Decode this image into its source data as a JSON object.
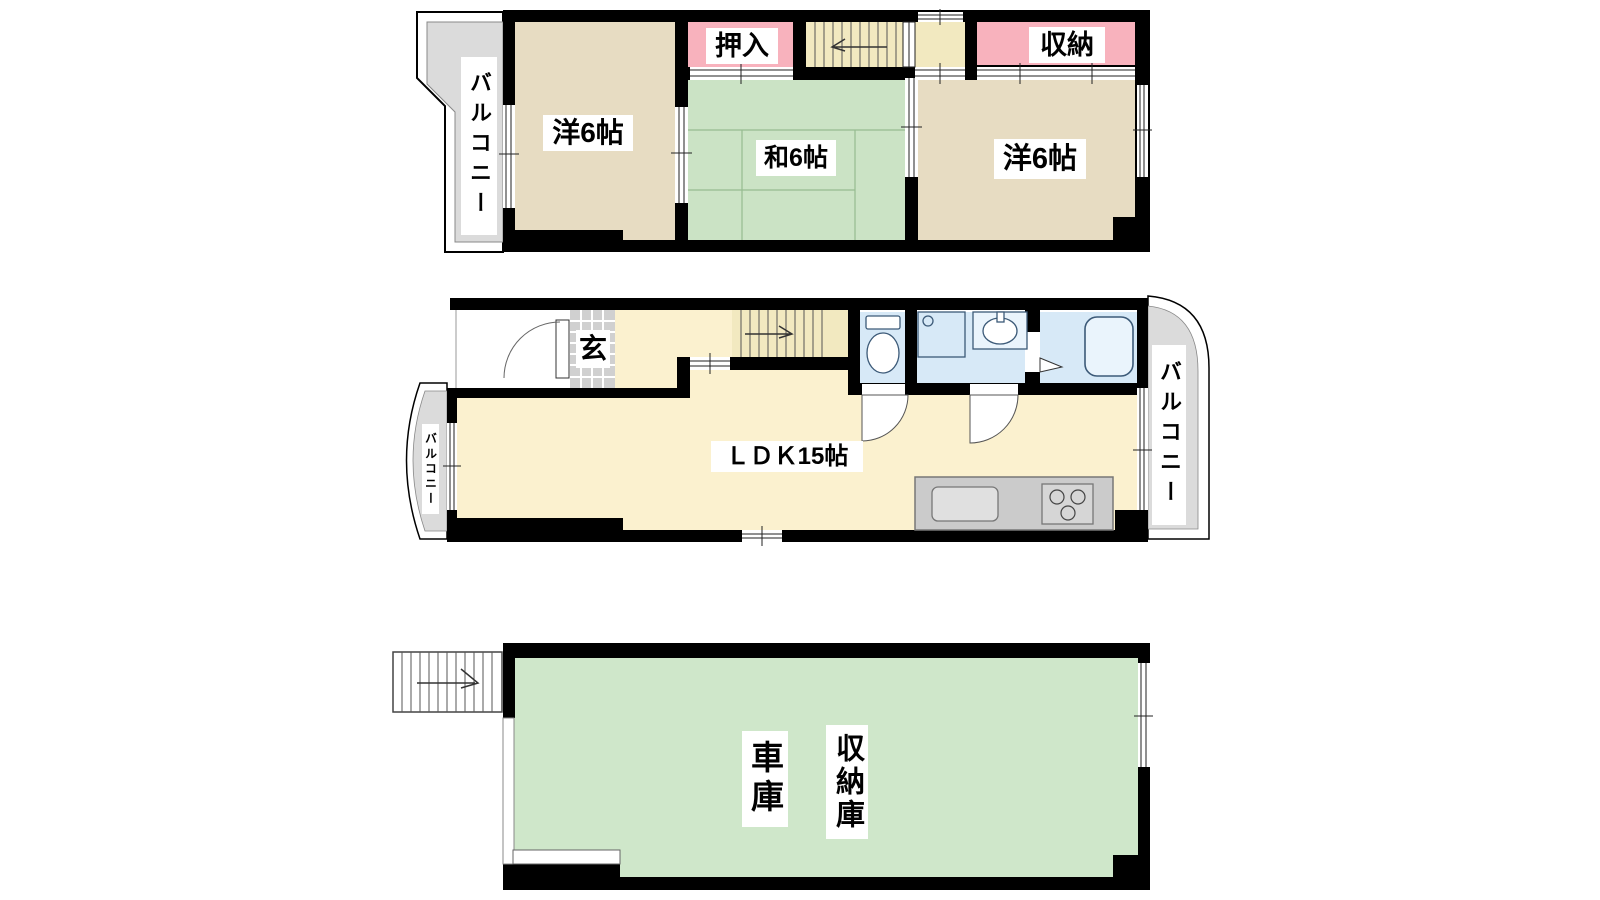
{
  "plan": {
    "type": "madori-floor-plan",
    "floors": [
      {
        "id": "3F",
        "rooms": [
          {
            "key": "balcony",
            "label": "バルコニー"
          },
          {
            "key": "western1",
            "label": "洋6帖"
          },
          {
            "key": "closet",
            "label": "押入"
          },
          {
            "key": "japanese",
            "label": "和6帖"
          },
          {
            "key": "storage",
            "label": "収納"
          },
          {
            "key": "western2",
            "label": "洋6帖"
          }
        ]
      },
      {
        "id": "2F",
        "rooms": [
          {
            "key": "entrance",
            "label": "玄"
          },
          {
            "key": "ldk",
            "label": "ＬＤＫ15帖"
          },
          {
            "key": "balcony_left",
            "label": "バルコニー"
          },
          {
            "key": "balcony_right",
            "label": "バルコニー"
          }
        ]
      },
      {
        "id": "1F",
        "rooms": [
          {
            "key": "garage",
            "label": "車庫"
          },
          {
            "key": "storage",
            "label": "収納庫"
          }
        ]
      }
    ]
  },
  "colors": {
    "wall": "#000000",
    "wood_room": "#E7DCC2",
    "tatami": "#CBE3C5",
    "closet_pink": "#F8B2BD",
    "stairs": "#F2E9C0",
    "floor_cream": "#FBF1CF",
    "bath_blue": "#D7E9F7",
    "counter": "#CBCBCB",
    "counter_inner": "#E0E0E0",
    "balcony": "#DBDBDB",
    "garage_green": "#CFE7CA",
    "tile": "#D0D0D0"
  }
}
